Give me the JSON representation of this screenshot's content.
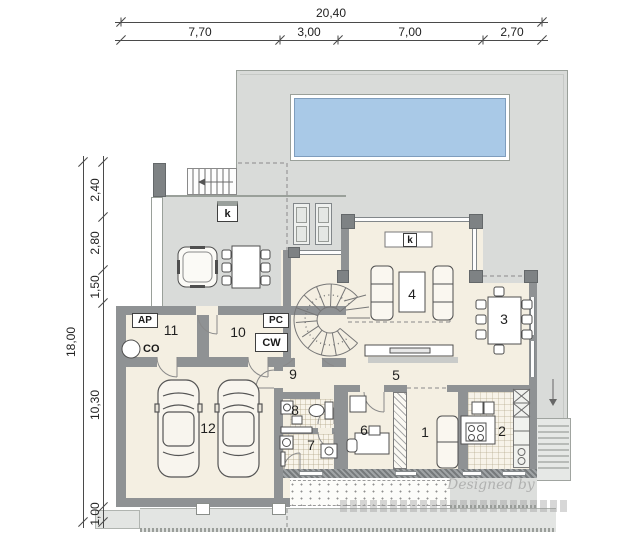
{
  "dimensions": {
    "top": {
      "total": "20,40",
      "s1": "7,70",
      "s2": "3,00",
      "s3": "7,00",
      "s4": "2,70"
    },
    "left": {
      "total": "18,00",
      "s1": "2,40",
      "s2": "2,80",
      "s3": "1,50",
      "s4": "10,30",
      "s5": "1,00"
    }
  },
  "rooms": {
    "r1": "1",
    "r2": "2",
    "r3": "3",
    "r4": "4",
    "r5": "5",
    "r6": "6",
    "r7": "7",
    "r8": "8",
    "r9": "9",
    "r10": "10",
    "r11": "11",
    "r12": "12"
  },
  "equipment_labels": {
    "ap": "AP",
    "co": "CO",
    "pc": "PC",
    "cw": "CW",
    "k_terrace": "k",
    "k_fireplace": "k"
  },
  "watermark": {
    "text": "Designed by"
  },
  "colors": {
    "terrace": "#d9dbd9",
    "floor": "#f4efe2",
    "pool_water": "#a9c9e7",
    "pool_edge": "#7f9dbd",
    "wall": "#8f9294"
  }
}
